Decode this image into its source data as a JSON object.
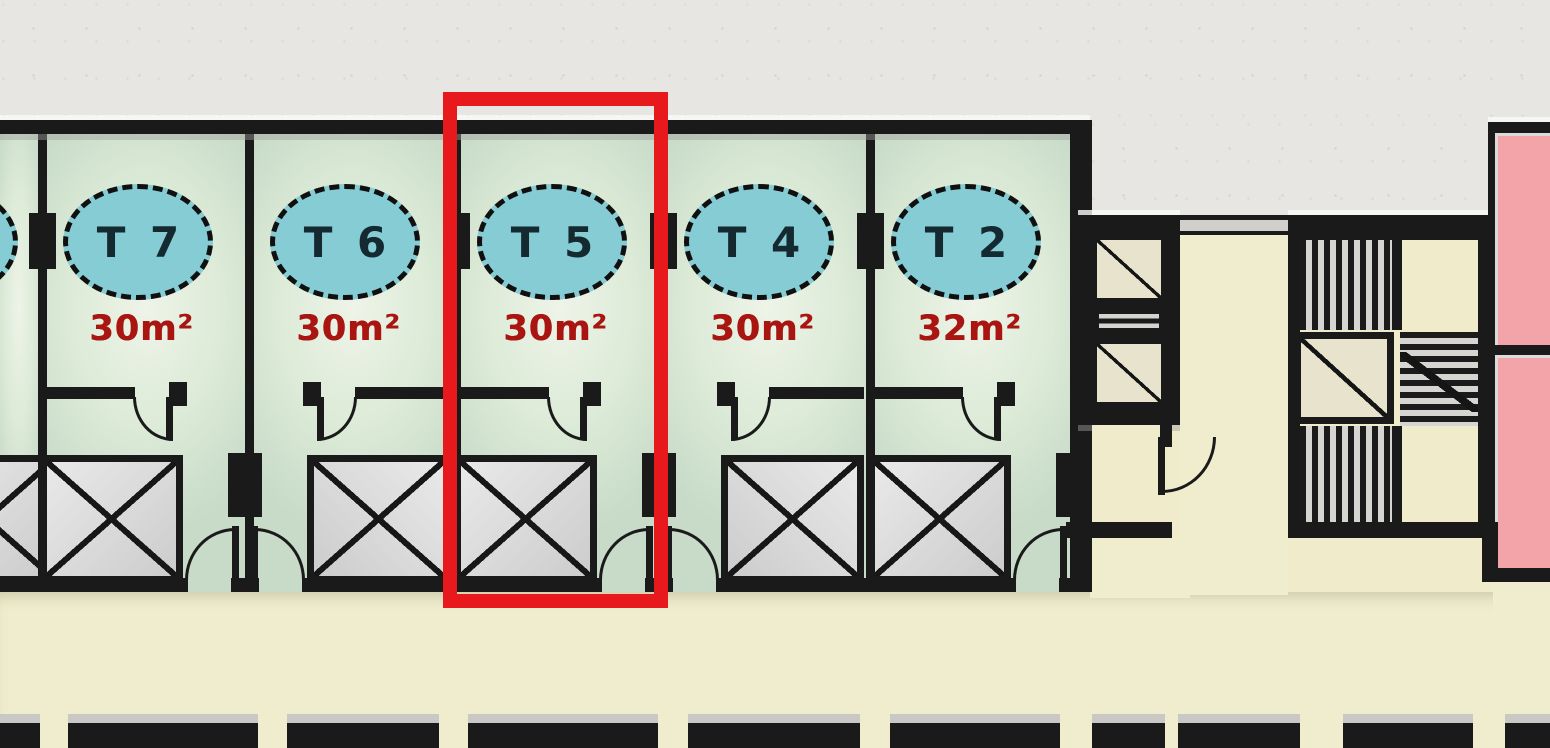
{
  "plan": {
    "units": [
      {
        "id": "T7",
        "label": "T 7",
        "area": "30m²",
        "mirrored": false,
        "highlighted": false
      },
      {
        "id": "T6",
        "label": "T 6",
        "area": "30m²",
        "mirrored": true,
        "highlighted": false
      },
      {
        "id": "T5",
        "label": "T 5",
        "area": "30m²",
        "mirrored": false,
        "highlighted": true
      },
      {
        "id": "T4",
        "label": "T 4",
        "area": "30m²",
        "mirrored": true,
        "highlighted": false
      },
      {
        "id": "T2",
        "label": "T 2",
        "area": "32m²",
        "mirrored": false,
        "highlighted": false
      }
    ],
    "highlight": {
      "unit_id": "T5",
      "color": "#e8191d"
    },
    "palette": {
      "wall": "#1a1a1a",
      "unit_floor_green": "#ddebd8",
      "unit_badge_fill": "#86ccd4",
      "unit_badge_text": "#142930",
      "area_text_red": "#a91510",
      "corridor_cream": "#f0ecce",
      "exterior_gray": "#e7e6e3",
      "shaft_box_gray": "#d9d9d9",
      "pink_room": "#f2a4a9",
      "highlight_red": "#e8191d"
    }
  }
}
